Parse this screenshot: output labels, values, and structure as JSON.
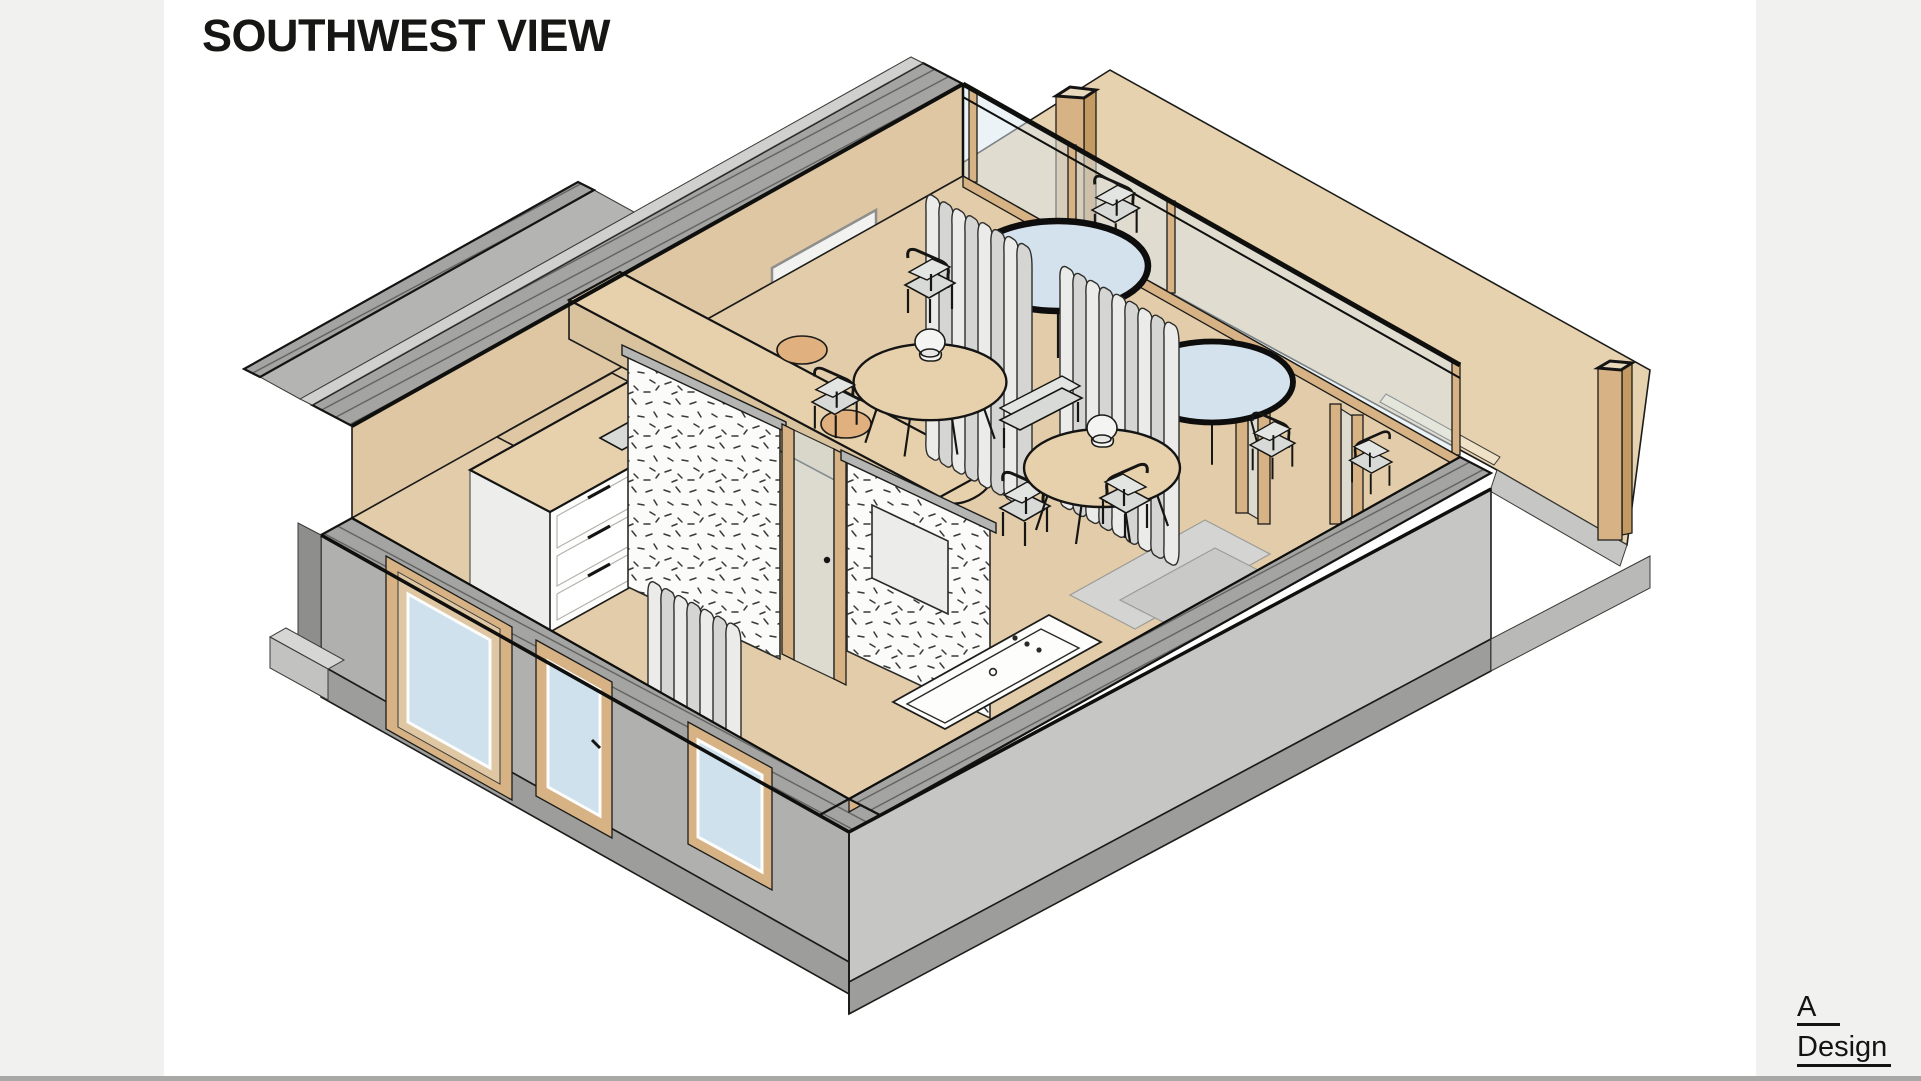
{
  "page": {
    "background": "#f1f1f0",
    "canvas": "#ffffff",
    "footer_bar": "#a8a8a6"
  },
  "header": {
    "title": "SOUTHWEST VIEW"
  },
  "brand": {
    "line1": "A",
    "line2": "Design"
  },
  "drawing": {
    "projection": "axonometric-cutaway",
    "view_direction": "southwest",
    "colors": {
      "outline": "#1c1c1a",
      "floor": "#e3cca9",
      "deck": "#e7d2b0",
      "deck_edge": "#efe2c6",
      "wall_tan": "#dfc7a4",
      "wood": "#d6b285",
      "wood_dark": "#c49a63",
      "concrete": "#b0b0ae",
      "concrete_light": "#c6c6c4",
      "plinth": "#9d9d9b",
      "cut_surface": "#a4a4a2",
      "glass": "#d9e7ef",
      "window_glass": "#cfe1ed",
      "partition_white": "#fbfbf9",
      "curtain": "#ebebe9",
      "curtain_shade": "#d5d5d3",
      "seat": "#d8dad8",
      "floor_mat": "#d4d4d2",
      "table_top": "#e7d1ac",
      "fixture_white": "#fdfdfc"
    },
    "elements": [
      "concrete-shell-walls",
      "stepped-hatched-parapet",
      "glazed-northeast-wall",
      "timber-mullions",
      "pleated-curtains",
      "roof-deck",
      "timber-posts",
      "kitchen-island",
      "bar-counter",
      "round-dining-tables",
      "table-lamps",
      "cafe-chairs",
      "bench-seat",
      "glass-top-tables",
      "terrazzo-partition-walls",
      "glass-doors",
      "vanity-mirror",
      "bathroom-sink",
      "timber-framed-windows",
      "floor-mats"
    ]
  }
}
